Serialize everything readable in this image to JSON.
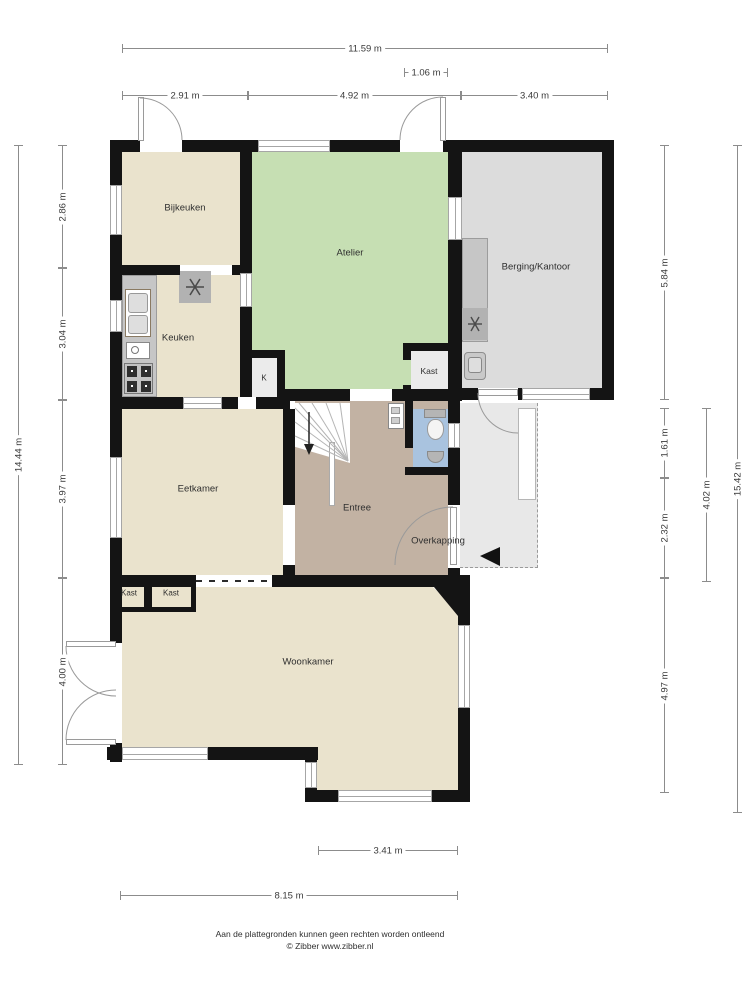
{
  "room_labels": [
    {
      "id": "bijkeuken",
      "label": "Bijkeuken",
      "x": 185,
      "y": 208,
      "fs": 9.5
    },
    {
      "id": "keuken",
      "label": "Keuken",
      "x": 178,
      "y": 338,
      "fs": 9.5
    },
    {
      "id": "atelier",
      "label": "Atelier",
      "x": 350,
      "y": 253,
      "fs": 9.5
    },
    {
      "id": "berging-kantoor",
      "label": "Berging/Kantoor",
      "x": 536,
      "y": 267,
      "fs": 9.5
    },
    {
      "id": "kast-atelier",
      "label": "Kast",
      "x": 429,
      "y": 371,
      "fs": 8.5
    },
    {
      "id": "k-closet",
      "label": "K",
      "x": 264,
      "y": 378,
      "fs": 8
    },
    {
      "id": "eetkamer",
      "label": "Eetkamer",
      "x": 198,
      "y": 489,
      "fs": 9.5
    },
    {
      "id": "entree",
      "label": "Entree",
      "x": 357,
      "y": 508,
      "fs": 9.5
    },
    {
      "id": "overkapping",
      "label": "Overkapping",
      "x": 438,
      "y": 541,
      "fs": 9.5
    },
    {
      "id": "kast-left",
      "label": "Kast",
      "x": 129,
      "y": 593,
      "fs": 8
    },
    {
      "id": "kast-right",
      "label": "Kast",
      "x": 171,
      "y": 593,
      "fs": 8
    },
    {
      "id": "woonkamer",
      "label": "Woonkamer",
      "x": 308,
      "y": 662,
      "fs": 9.5
    }
  ],
  "dimensions": [
    {
      "label": "11.59 m",
      "orient": "h",
      "x": 122,
      "y": 48,
      "len": 486
    },
    {
      "label": "1.06 m",
      "orient": "h",
      "x": 404,
      "y": 72,
      "len": 44
    },
    {
      "label": "2.91 m",
      "orient": "h",
      "x": 122,
      "y": 95,
      "len": 126
    },
    {
      "label": "4.92 m",
      "orient": "h",
      "x": 248,
      "y": 95,
      "len": 213
    },
    {
      "label": "3.40 m",
      "orient": "h",
      "x": 461,
      "y": 95,
      "len": 147
    },
    {
      "label": "14.44 m",
      "orient": "v",
      "x": 18,
      "y": 145,
      "len": 620
    },
    {
      "label": "2.86 m",
      "orient": "v",
      "x": 62,
      "y": 145,
      "len": 123
    },
    {
      "label": "3.04 m",
      "orient": "v",
      "x": 62,
      "y": 268,
      "len": 132
    },
    {
      "label": "3.97 m",
      "orient": "v",
      "x": 62,
      "y": 400,
      "len": 178
    },
    {
      "label": "4.00 m",
      "orient": "v",
      "x": 62,
      "y": 578,
      "len": 187
    },
    {
      "label": "5.84 m",
      "orient": "v",
      "x": 664,
      "y": 145,
      "len": 255
    },
    {
      "label": "1.61 m",
      "orient": "v",
      "x": 664,
      "y": 408,
      "len": 70
    },
    {
      "label": "2.32 m",
      "orient": "v",
      "x": 664,
      "y": 478,
      "len": 100
    },
    {
      "label": "4.97 m",
      "orient": "v",
      "x": 664,
      "y": 578,
      "len": 215
    },
    {
      "label": "4.02 m",
      "orient": "v",
      "x": 706,
      "y": 408,
      "len": 174
    },
    {
      "label": "15.42 m",
      "orient": "v",
      "x": 737,
      "y": 145,
      "len": 668
    },
    {
      "label": "3.41 m",
      "orient": "h",
      "x": 318,
      "y": 850,
      "len": 140
    },
    {
      "label": "8.15 m",
      "orient": "h",
      "x": 120,
      "y": 895,
      "len": 338
    }
  ],
  "footer": {
    "line1": "Aan de plattegronden kunnen geen rechten worden ontleend",
    "line2": "© Zibber www.zibber.nl"
  },
  "colors": {
    "wall": "#141414",
    "beige": "#eae3cd",
    "green": "#c6dfb3",
    "taupe": "#c2b2a3",
    "gray_room": "#dcdcdc",
    "light_gray": "#e8e8e8",
    "closet": "#ebebeb",
    "blue": "#a9c3df",
    "counter": "#c6c6c6",
    "appliance": "#b2b2b2",
    "dim_line": "#8c8c8c",
    "text": "#2f2f2f"
  }
}
